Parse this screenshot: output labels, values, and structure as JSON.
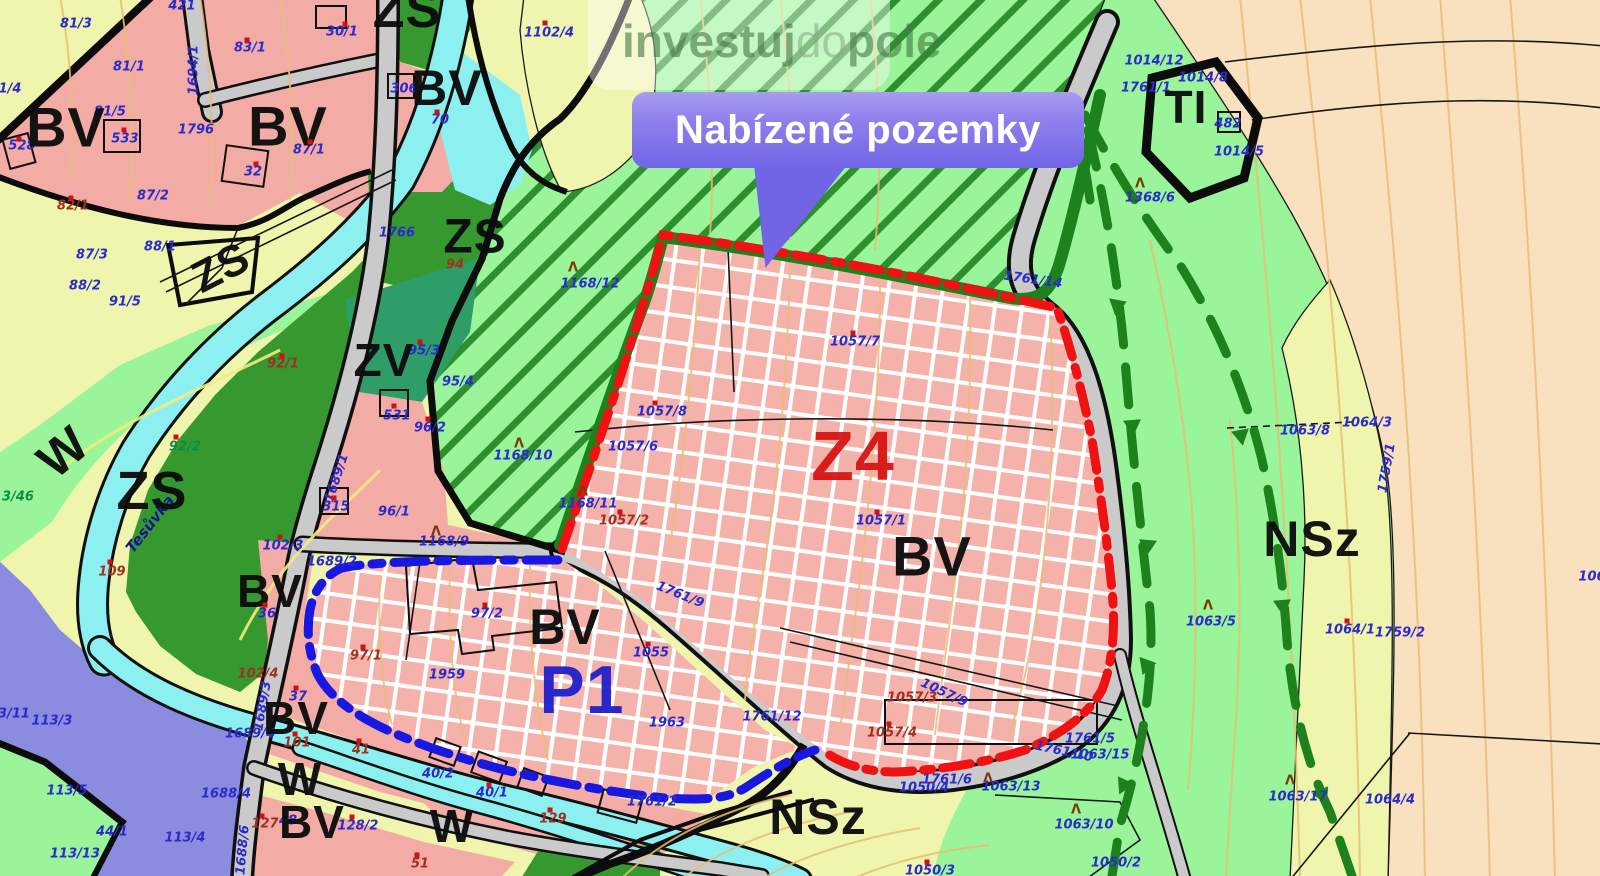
{
  "banner": {
    "title": "Nabízené pozemky"
  },
  "watermark": {
    "part1": "investuj",
    "part2": "do",
    "part3": "pole"
  },
  "colors": {
    "bv_pink": "#f3aba5",
    "hatch_pink": "#f5b2ab",
    "nsz_yellow": "#eff5ad",
    "zs_green": "#35992f",
    "zv_teal": "#2f9d68",
    "meadow_green": "#9af49a",
    "orchard_peach": "#f9e0bf",
    "water_cyan": "#8cf0f0",
    "mixed_purple": "#8b8bdf",
    "road_gray": "#cacaca",
    "ti_gray": "#7b7b7b",
    "contour_orange": "#e8bd74",
    "z4_boundary_red": "#ee1212",
    "p1_boundary_blue": "#1818e0",
    "green_boundary": "#1d811d",
    "banner_purple": "#7165e5",
    "label_blue": "#2b2bcc"
  },
  "tree_glyph": "Λ",
  "zone_labels": [
    {
      "t": "ZS",
      "x": 407,
      "y": 10,
      "s": 52
    },
    {
      "t": "BV",
      "x": 66,
      "y": 127,
      "s": 56
    },
    {
      "t": "BV",
      "x": 288,
      "y": 126,
      "s": 56
    },
    {
      "t": "BV",
      "x": 447,
      "y": 88,
      "s": 50
    },
    {
      "t": "ZS",
      "x": 221,
      "y": 268,
      "s": 44,
      "r": -27
    },
    {
      "t": "ZS",
      "x": 475,
      "y": 237,
      "s": 48
    },
    {
      "t": "ZV",
      "x": 384,
      "y": 360,
      "s": 46
    },
    {
      "t": "ZS",
      "x": 152,
      "y": 491,
      "s": 54
    },
    {
      "t": "W",
      "x": 63,
      "y": 452,
      "s": 50,
      "r": -40
    },
    {
      "t": "BV",
      "x": 270,
      "y": 591,
      "s": 46
    },
    {
      "t": "BV",
      "x": 296,
      "y": 718,
      "s": 46
    },
    {
      "t": "W",
      "x": 300,
      "y": 779,
      "s": 46
    },
    {
      "t": "BV",
      "x": 312,
      "y": 822,
      "s": 46
    },
    {
      "t": "W",
      "x": 452,
      "y": 826,
      "s": 46
    },
    {
      "t": "BV",
      "x": 565,
      "y": 627,
      "s": 50
    },
    {
      "t": "BV",
      "x": 932,
      "y": 556,
      "s": 56
    },
    {
      "t": "Z4",
      "x": 853,
      "y": 456,
      "s": 70,
      "c": "red"
    },
    {
      "t": "P1",
      "x": 582,
      "y": 690,
      "s": 68,
      "c": "blue"
    },
    {
      "t": "NSz",
      "x": 818,
      "y": 817,
      "s": 50
    },
    {
      "t": "NSz",
      "x": 1312,
      "y": 539,
      "s": 50
    },
    {
      "t": "TI",
      "x": 1186,
      "y": 107,
      "s": 46
    }
  ],
  "parcel_labels": [
    {
      "t": "421",
      "x": 182,
      "y": 6
    },
    {
      "t": "81/3",
      "x": 76,
      "y": 24
    },
    {
      "t": "81/1",
      "x": 129,
      "y": 67
    },
    {
      "t": "1/4",
      "x": 10,
      "y": 89
    },
    {
      "t": "81/5",
      "x": 110,
      "y": 112
    },
    {
      "t": "528",
      "x": 22,
      "y": 146
    },
    {
      "t": "533",
      "x": 125,
      "y": 139
    },
    {
      "t": "83/1",
      "x": 250,
      "y": 48
    },
    {
      "t": "30/1",
      "x": 342,
      "y": 32
    },
    {
      "t": "1796",
      "x": 196,
      "y": 130
    },
    {
      "t": "87/1",
      "x": 309,
      "y": 150
    },
    {
      "t": "32",
      "x": 253,
      "y": 172
    },
    {
      "t": "82/1",
      "x": 73,
      "y": 206,
      "c": "brown"
    },
    {
      "t": "87/2",
      "x": 153,
      "y": 196
    },
    {
      "t": "88/1",
      "x": 160,
      "y": 247
    },
    {
      "t": "87/3",
      "x": 92,
      "y": 255
    },
    {
      "t": "88/2",
      "x": 85,
      "y": 286
    },
    {
      "t": "91/5",
      "x": 125,
      "y": 302
    },
    {
      "t": "1694/1",
      "x": 194,
      "y": 70,
      "r": -90
    },
    {
      "t": "306",
      "x": 404,
      "y": 89
    },
    {
      "t": "70",
      "x": 440,
      "y": 120
    },
    {
      "t": "1102/4",
      "x": 549,
      "y": 33
    },
    {
      "t": "1766",
      "x": 397,
      "y": 233
    },
    {
      "t": "94",
      "x": 455,
      "y": 265,
      "c": "brown"
    },
    {
      "t": "92/1",
      "x": 283,
      "y": 364,
      "c": "brown"
    },
    {
      "t": "95/3",
      "x": 424,
      "y": 351
    },
    {
      "t": "95/4",
      "x": 458,
      "y": 382
    },
    {
      "t": "531",
      "x": 397,
      "y": 416
    },
    {
      "t": "96/2",
      "x": 430,
      "y": 428
    },
    {
      "t": "96/1",
      "x": 394,
      "y": 512
    },
    {
      "t": "315",
      "x": 336,
      "y": 507
    },
    {
      "t": "92/2",
      "x": 185,
      "y": 447,
      "c": "green"
    },
    {
      "t": "109",
      "x": 112,
      "y": 572,
      "c": "brown"
    },
    {
      "t": "3/46",
      "x": 18,
      "y": 497,
      "c": "green"
    },
    {
      "t": "1689/1",
      "x": 337,
      "y": 478,
      "r": -72
    },
    {
      "t": "102/3",
      "x": 283,
      "y": 546
    },
    {
      "t": "1689/2",
      "x": 332,
      "y": 562
    },
    {
      "t": "1168/12",
      "x": 590,
      "y": 284
    },
    {
      "t": "1168/10",
      "x": 523,
      "y": 456
    },
    {
      "t": "1168/11",
      "x": 588,
      "y": 504
    },
    {
      "t": "1168/9",
      "x": 444,
      "y": 542
    },
    {
      "t": "1057/8",
      "x": 662,
      "y": 412
    },
    {
      "t": "1057/6",
      "x": 633,
      "y": 447
    },
    {
      "t": "1057/2",
      "x": 624,
      "y": 521,
      "c": "brown"
    },
    {
      "t": "1057/7",
      "x": 855,
      "y": 342
    },
    {
      "t": "1057/1",
      "x": 881,
      "y": 521
    },
    {
      "t": "1761/14",
      "x": 1033,
      "y": 280,
      "r": 8
    },
    {
      "t": "1761/9",
      "x": 680,
      "y": 595,
      "r": 22
    },
    {
      "t": "1055",
      "x": 651,
      "y": 653
    },
    {
      "t": "97/2",
      "x": 487,
      "y": 614
    },
    {
      "t": "97/1",
      "x": 366,
      "y": 656,
      "c": "brown"
    },
    {
      "t": "1959",
      "x": 447,
      "y": 675
    },
    {
      "t": "1963",
      "x": 667,
      "y": 723
    },
    {
      "t": "1761/12",
      "x": 772,
      "y": 717
    },
    {
      "t": "1057/3",
      "x": 912,
      "y": 698,
      "c": "brown"
    },
    {
      "t": "1057/9",
      "x": 944,
      "y": 693,
      "r": 25
    },
    {
      "t": "1057/4",
      "x": 892,
      "y": 733,
      "c": "brown"
    },
    {
      "t": "1761/5",
      "x": 1090,
      "y": 739
    },
    {
      "t": "1761/10",
      "x": 1064,
      "y": 752,
      "r": 12
    },
    {
      "t": "1063/15",
      "x": 1100,
      "y": 755
    },
    {
      "t": "1761/6",
      "x": 947,
      "y": 780
    },
    {
      "t": "1050/4",
      "x": 924,
      "y": 788
    },
    {
      "t": "1063/13",
      "x": 1011,
      "y": 787
    },
    {
      "t": "1063/10",
      "x": 1084,
      "y": 825
    },
    {
      "t": "1050/2",
      "x": 1116,
      "y": 863
    },
    {
      "t": "1050/3",
      "x": 930,
      "y": 871
    },
    {
      "t": "1761/2",
      "x": 652,
      "y": 802
    },
    {
      "t": "36",
      "x": 267,
      "y": 614
    },
    {
      "t": "37",
      "x": 298,
      "y": 697
    },
    {
      "t": "102/4",
      "x": 258,
      "y": 674,
      "c": "brown"
    },
    {
      "t": "1689/4",
      "x": 250,
      "y": 734
    },
    {
      "t": "1689/3",
      "x": 263,
      "y": 706,
      "r": -80
    },
    {
      "t": "101",
      "x": 297,
      "y": 743,
      "c": "brown"
    },
    {
      "t": "127",
      "x": 265,
      "y": 824,
      "c": "brown"
    },
    {
      "t": "48",
      "x": 288,
      "y": 821
    },
    {
      "t": "128/2",
      "x": 358,
      "y": 826
    },
    {
      "t": "1688/4",
      "x": 226,
      "y": 794
    },
    {
      "t": "1688/6",
      "x": 243,
      "y": 850,
      "r": -85
    },
    {
      "t": "51",
      "x": 420,
      "y": 864,
      "c": "brown"
    },
    {
      "t": "41",
      "x": 361,
      "y": 750,
      "c": "brown"
    },
    {
      "t": "40/2",
      "x": 438,
      "y": 774
    },
    {
      "t": "40/1",
      "x": 492,
      "y": 793
    },
    {
      "t": "129",
      "x": 553,
      "y": 819,
      "c": "brown"
    },
    {
      "t": "3/11",
      "x": 14,
      "y": 714
    },
    {
      "t": "113/3",
      "x": 52,
      "y": 721
    },
    {
      "t": "113/5",
      "x": 67,
      "y": 791
    },
    {
      "t": "44/1",
      "x": 112,
      "y": 832
    },
    {
      "t": "113/4",
      "x": 185,
      "y": 838
    },
    {
      "t": "113/13",
      "x": 75,
      "y": 854
    },
    {
      "t": "1014/12",
      "x": 1154,
      "y": 61
    },
    {
      "t": "1014/8",
      "x": 1203,
      "y": 78
    },
    {
      "t": "1761/1",
      "x": 1146,
      "y": 88
    },
    {
      "t": "482",
      "x": 1228,
      "y": 124
    },
    {
      "t": "1014/5",
      "x": 1239,
      "y": 152
    },
    {
      "t": "1368/6",
      "x": 1150,
      "y": 198
    },
    {
      "t": "1063/5",
      "x": 1211,
      "y": 622
    },
    {
      "t": "1063/8",
      "x": 1305,
      "y": 431
    },
    {
      "t": "1064/3",
      "x": 1367,
      "y": 423
    },
    {
      "t": "1759/1",
      "x": 1387,
      "y": 468,
      "r": -80
    },
    {
      "t": "1064/1",
      "x": 1350,
      "y": 630
    },
    {
      "t": "1759/2",
      "x": 1400,
      "y": 633
    },
    {
      "t": "106",
      "x": 1592,
      "y": 577
    },
    {
      "t": "1063/17",
      "x": 1298,
      "y": 797
    },
    {
      "t": "1064/4",
      "x": 1390,
      "y": 800
    },
    {
      "t": "Tesůvka",
      "x": 150,
      "y": 524,
      "r": -52,
      "c": "river"
    }
  ],
  "trees": [
    {
      "x": 573,
      "y": 268
    },
    {
      "x": 519,
      "y": 444
    },
    {
      "x": 583,
      "y": 492
    },
    {
      "x": 436,
      "y": 532
    },
    {
      "x": 1208,
      "y": 606
    },
    {
      "x": 988,
      "y": 779
    },
    {
      "x": 1076,
      "y": 810
    },
    {
      "x": 1290,
      "y": 781
    },
    {
      "x": 1140,
      "y": 184
    }
  ],
  "marks": [
    {
      "x": 545,
      "y": 23
    },
    {
      "x": 247,
      "y": 40
    },
    {
      "x": 345,
      "y": 24
    },
    {
      "x": 310,
      "y": 142
    },
    {
      "x": 256,
      "y": 164
    },
    {
      "x": 437,
      "y": 112
    },
    {
      "x": 124,
      "y": 130
    },
    {
      "x": 19,
      "y": 139
    },
    {
      "x": 71,
      "y": 198
    },
    {
      "x": 176,
      "y": 437
    },
    {
      "x": 282,
      "y": 356
    },
    {
      "x": 428,
      "y": 419
    },
    {
      "x": 420,
      "y": 342
    },
    {
      "x": 394,
      "y": 406
    },
    {
      "x": 334,
      "y": 498
    },
    {
      "x": 853,
      "y": 333
    },
    {
      "x": 877,
      "y": 512
    },
    {
      "x": 655,
      "y": 403
    },
    {
      "x": 620,
      "y": 512
    },
    {
      "x": 889,
      "y": 724
    },
    {
      "x": 648,
      "y": 644
    },
    {
      "x": 485,
      "y": 605
    },
    {
      "x": 363,
      "y": 647
    },
    {
      "x": 489,
      "y": 785
    },
    {
      "x": 359,
      "y": 741
    },
    {
      "x": 295,
      "y": 734
    },
    {
      "x": 262,
      "y": 816
    },
    {
      "x": 352,
      "y": 817
    },
    {
      "x": 417,
      "y": 855
    },
    {
      "x": 265,
      "y": 605
    },
    {
      "x": 296,
      "y": 688
    },
    {
      "x": 280,
      "y": 537
    },
    {
      "x": 927,
      "y": 862
    },
    {
      "x": 1347,
      "y": 621
    },
    {
      "x": 550,
      "y": 810
    },
    {
      "x": 110,
      "y": 562
    }
  ]
}
